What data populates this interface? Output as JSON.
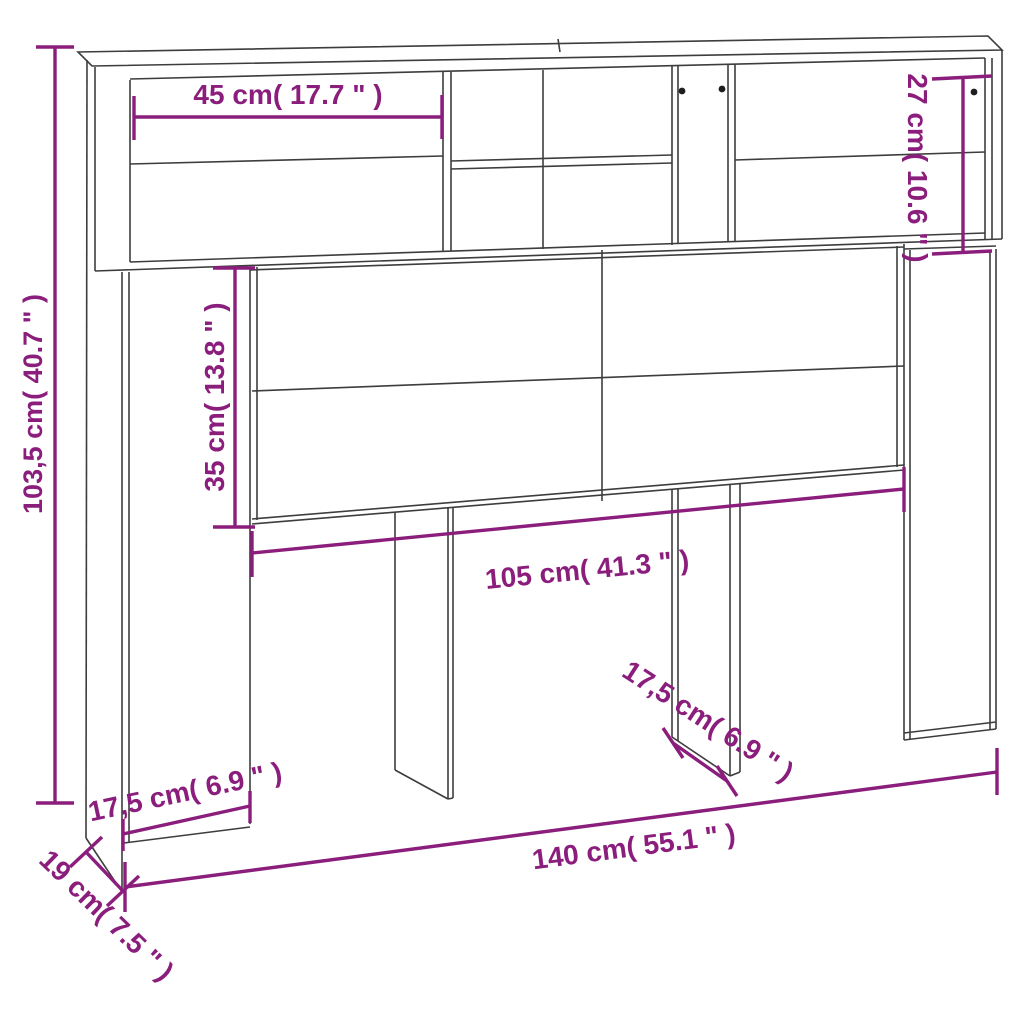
{
  "diagram": {
    "kind": "furniture-dimension-diagram",
    "subject": "headboard cabinet with shelves",
    "accent_color": "#8b1e7c",
    "line_color": "#3d3d3d",
    "background": "#ffffff"
  },
  "dim": {
    "top_opening_width": {
      "label": "45 cm( 17.7 \" )",
      "cm": "45",
      "inches": "17.7"
    },
    "hutch_height": {
      "label": "27 cm( 10.6 \" )",
      "cm": "27",
      "inches": "10.6"
    },
    "overall_height": {
      "label": "103,5 cm( 40.7 \" )",
      "cm": "103,5",
      "inches": "40.7"
    },
    "door_panel_height": {
      "label": "35 cm( 13.8 \" )",
      "cm": "35",
      "inches": "13.8"
    },
    "inner_width": {
      "label": "105 cm( 41.3 \" )",
      "cm": "105",
      "inches": "41.3"
    },
    "left_column_width": {
      "label": "17,5 cm( 6.9 \" )",
      "cm": "17,5",
      "inches": "6.9"
    },
    "leg_depth": {
      "label": "17,5 cm( 6.9 \" )",
      "cm": "17,5",
      "inches": "6.9"
    },
    "overall_width": {
      "label": "140 cm( 55.1 \" )",
      "cm": "140",
      "inches": "55.1"
    },
    "overall_depth": {
      "label": "19 cm( 7.5 \" )",
      "cm": "19",
      "inches": "7.5"
    }
  }
}
